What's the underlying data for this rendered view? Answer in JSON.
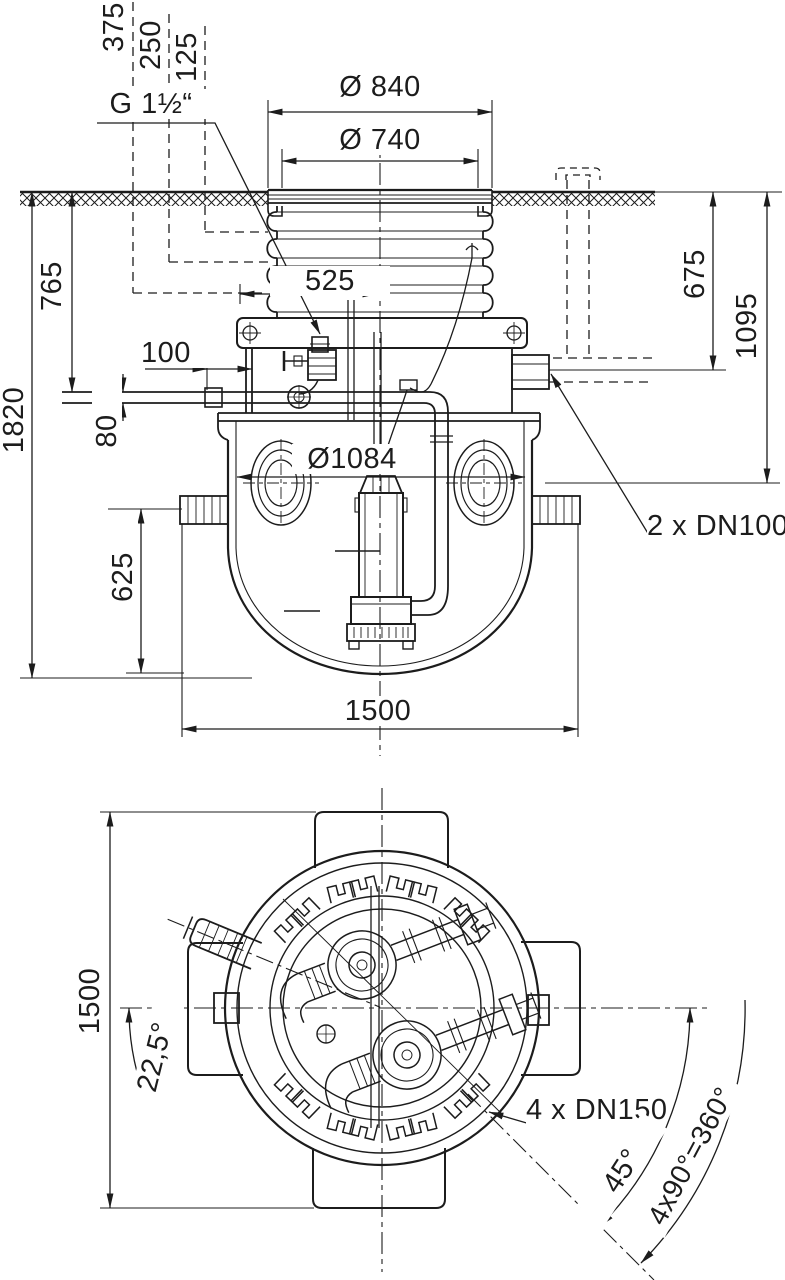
{
  "page": {
    "background": "#ffffff",
    "ink": "#1c1c1c"
  },
  "elevation_view": {
    "riser_extension_heights": [
      "375",
      "250",
      "125"
    ],
    "vent_connection_label": "G 1½“",
    "cover_outer_diameter": "Ø 840",
    "cover_clear_diameter": "Ø 740",
    "depth_to_outlet": "765",
    "total_depth": "1820",
    "outlet_stub_length": "100",
    "outlet_drop": "80",
    "outlet_offset_from_center": "525",
    "tank_inner_diameter": "Ø1084",
    "inlet_depth_option_1": "675",
    "inlet_depth_option_2": "1095",
    "inlet_connections_label": "2 x DN100",
    "sump_bottom_height": "625",
    "tank_overall_width": "1500"
  },
  "plan_view": {
    "overall_width": "1500",
    "swivel_step_angle": "22,5°",
    "outlet_connections_label": "4 x DN150",
    "position_angle": "45°",
    "full_rotation_note": "4x90°=360°"
  }
}
